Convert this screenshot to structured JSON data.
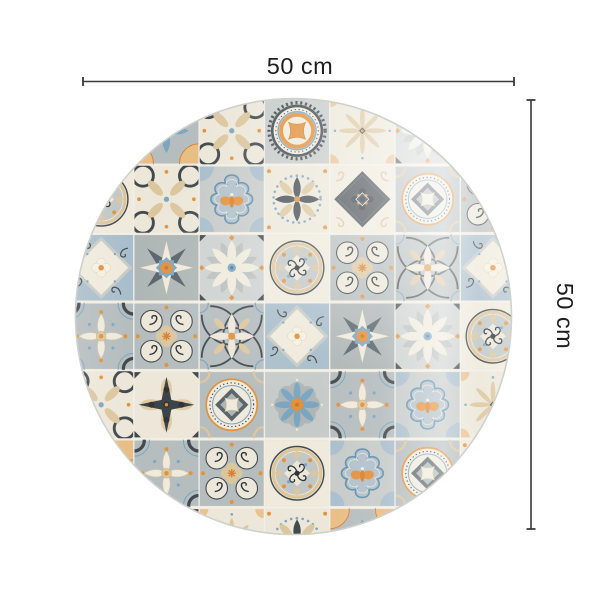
{
  "page": {
    "background_color": "#FFFFFF"
  },
  "diagram": {
    "type": "product-dimension-diagram",
    "width_dimension": {
      "label": "50 cm",
      "orientation": "horizontal",
      "position": "top"
    },
    "height_dimension": {
      "label": "50 cm",
      "orientation": "vertical",
      "position": "right"
    },
    "line_color": "#3B3B3B",
    "text_color": "#1E1E1E"
  },
  "mat": {
    "shape": "circle",
    "pattern": "patchwork-azulejo-tiles",
    "palette": {
      "orange": "#E2913C",
      "orange2": "#D97F2F",
      "blue": "#7BA6C2",
      "bluegray": "#A9BECB",
      "slate": "#5A646B",
      "charcoal": "#434A4F",
      "ink": "#2F3538",
      "gray0": "#CDD2D0",
      "gray1": "#C6CBC9",
      "gray2": "#B6BDBE",
      "gray3": "#AFB6B6",
      "cream": "#EFEADC",
      "cream2": "#ECE7D9",
      "beige": "#DCC69E"
    },
    "motifs": {
      "med": "serrated-medallion",
      "fan": "corner-fans-blue-cross",
      "rp": "corner-rings-beige-petals",
      "qm": "quatrefoil-lantern-moth",
      "sc": "dark-leaf-cross-dotted-ring",
      "dd": "dark-diamond-dot-star",
      "bd": "bullseye-diamond-medallion",
      "sr": "eight-point-star-rosette",
      "wr": "white-sixteen-petal-rosette",
      "wc": "wreath-circle-scroll-asterisks",
      "fm": "four-scroll-medallions",
      "al": "interlaced-arcs-lily",
      "df": "diamond-with-flower-flourish",
      "bz": "blue-daisy-orange-star",
      "cs": "compass-star-dark",
      "pc": "petal-cross-corner-rings",
      "sn": "beige-snowflake"
    },
    "grid": {
      "rows": 7,
      "cols": 7,
      "layout": [
        [
          "df",
          "fan",
          "rp",
          "med",
          "sn",
          "wr",
          "rp"
        ],
        [
          "wc",
          "rp",
          "qm",
          "sc",
          "dd",
          "bd",
          "fm"
        ],
        [
          "df",
          "sr",
          "wr",
          "wc",
          "fm",
          "al",
          "df"
        ],
        [
          "pc",
          "fm",
          "al",
          "df",
          "sr",
          "wr",
          "wc"
        ],
        [
          "rp",
          "cs",
          "bd",
          "bz",
          "pc",
          "qm",
          "sn"
        ],
        [
          "fan",
          "pc",
          "fm",
          "wc",
          "qm",
          "bd",
          "sc"
        ],
        [
          "wr",
          "cs",
          "sn",
          "sc",
          "fan",
          "sr",
          "rp"
        ]
      ]
    }
  }
}
